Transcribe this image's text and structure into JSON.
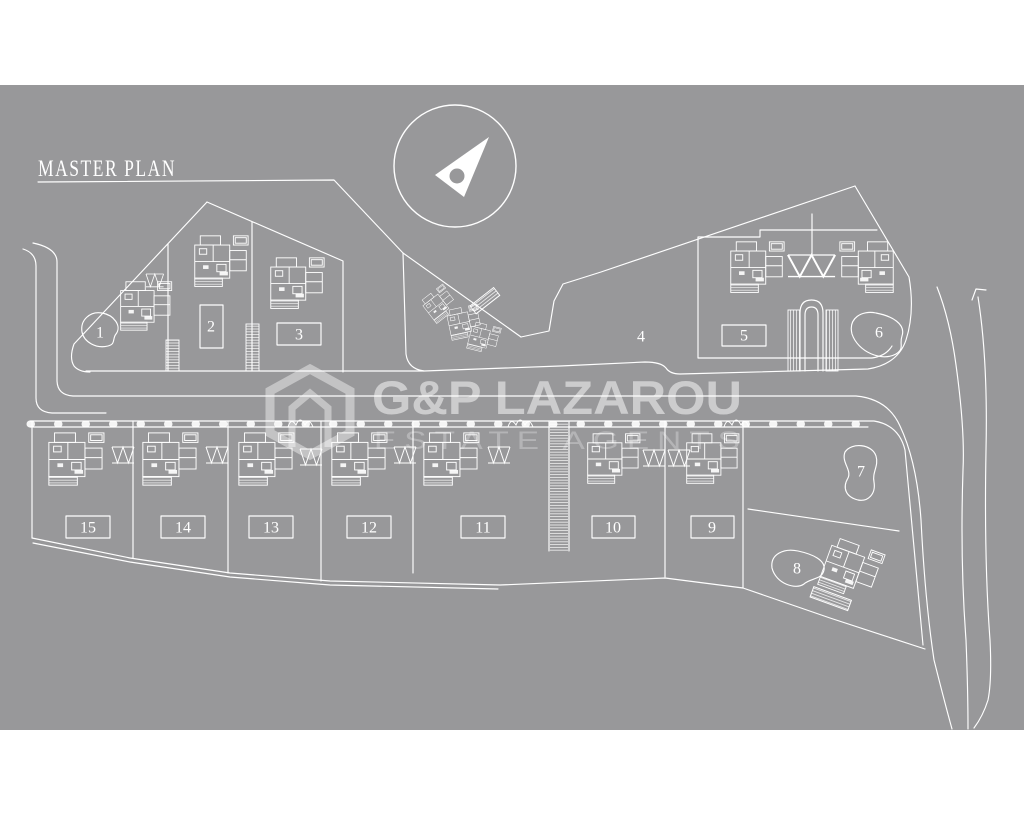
{
  "title": {
    "text": "MASTER PLAN"
  },
  "watermark": {
    "brand": "G&P LAZAROU",
    "tagline": "ESTATE AGENTS",
    "logo": "hexagon-house-logo"
  },
  "compass": {
    "icon": "north-arrow-icon"
  },
  "colors": {
    "page_background": "#ffffff",
    "plan_background": "#98989a",
    "line": "#ffffff",
    "watermark_text": "rgba(255,255,255,0.5)"
  },
  "plots": [
    {
      "label": "1",
      "marker": "pond"
    },
    {
      "label": "2",
      "marker": "pool"
    },
    {
      "label": "3",
      "marker": "pool"
    },
    {
      "label": "4",
      "marker": "open-land"
    },
    {
      "label": "5",
      "marker": "pool"
    },
    {
      "label": "6",
      "marker": "pond"
    },
    {
      "label": "7",
      "marker": "pond"
    },
    {
      "label": "8",
      "marker": "pond"
    },
    {
      "label": "9",
      "marker": "pool"
    },
    {
      "label": "10",
      "marker": "pool"
    },
    {
      "label": "11",
      "marker": "pool"
    },
    {
      "label": "12",
      "marker": "pool"
    },
    {
      "label": "13",
      "marker": "pool"
    },
    {
      "label": "14",
      "marker": "pool"
    },
    {
      "label": "15",
      "marker": "pool"
    }
  ]
}
